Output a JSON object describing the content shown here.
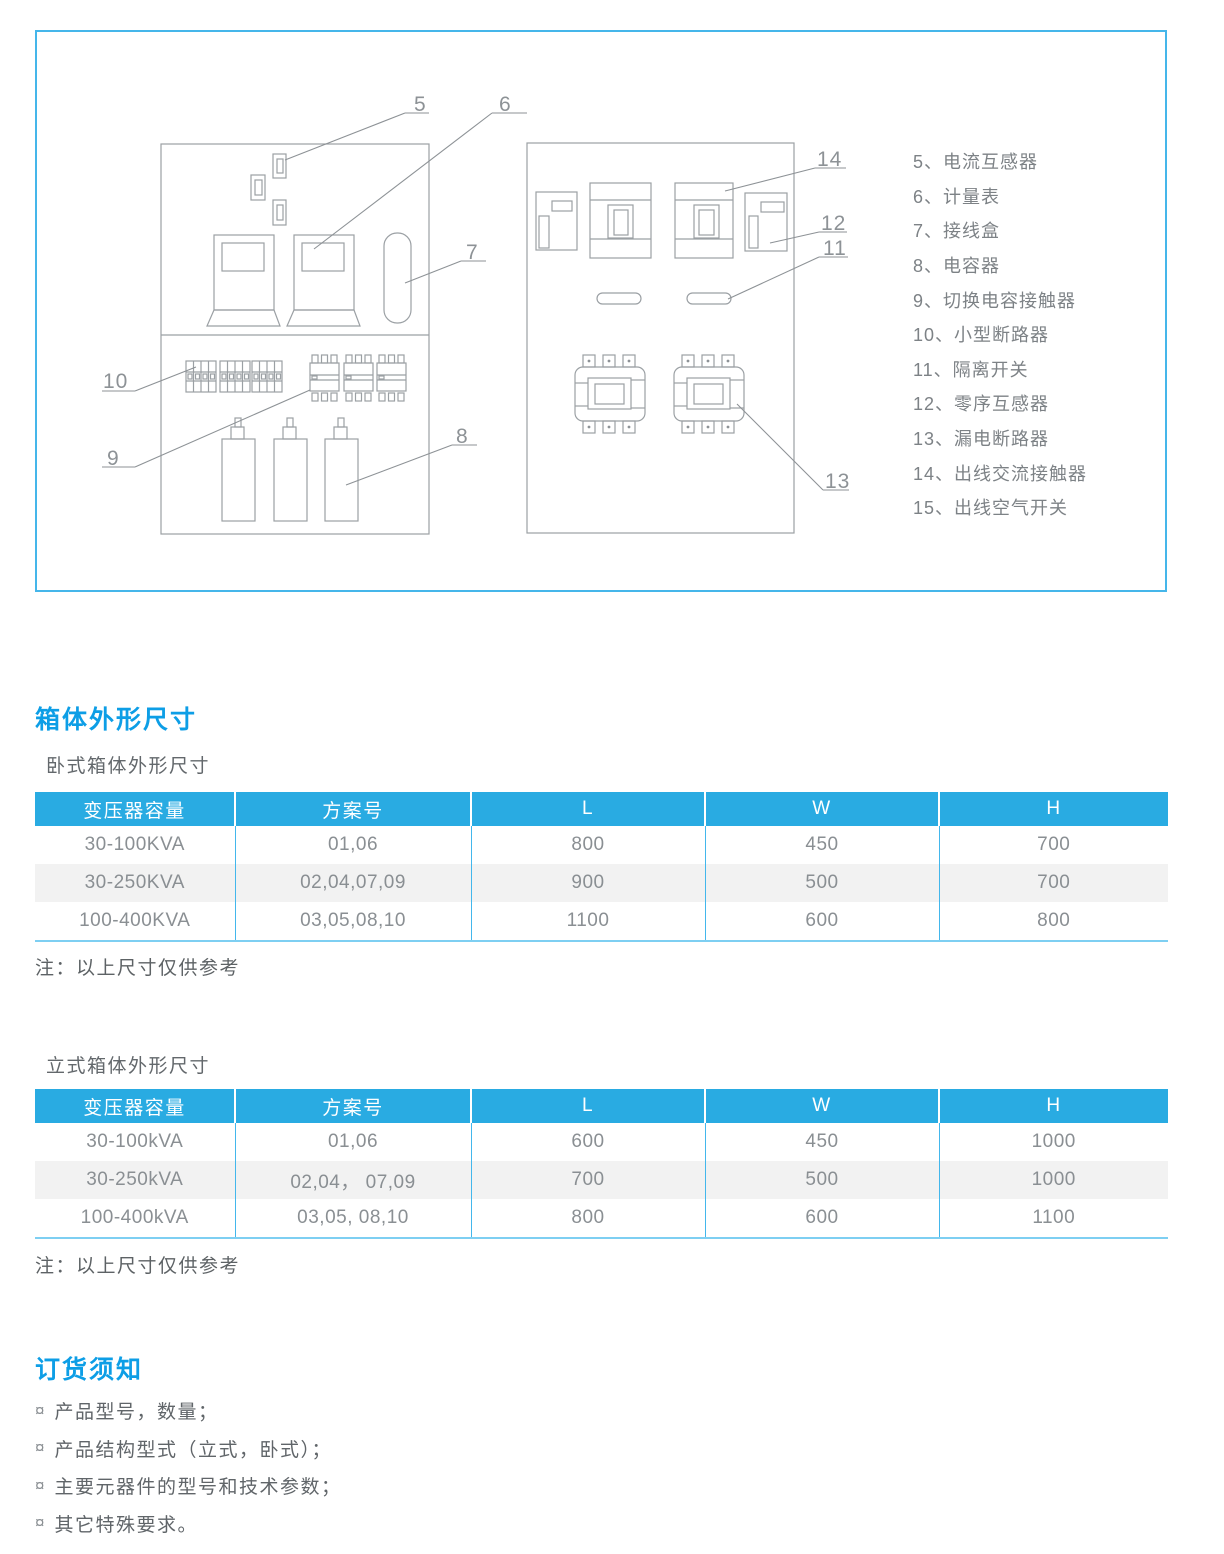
{
  "diagram": {
    "legend": [
      "5、电流互感器",
      "6、计量表",
      "7、接线盒",
      "8、电容器",
      "9、切换电容接触器",
      "10、小型断路器",
      "11、隔离开关",
      "12、零序互感器",
      "13、漏电断路器",
      "14、出线交流接触器",
      "15、出线空气开关"
    ],
    "callouts": {
      "c5": "5",
      "c6": "6",
      "c7": "7",
      "c8": "8",
      "c9": "9",
      "c10": "10",
      "c11": "11",
      "c12": "12",
      "c13": "13",
      "c14": "14"
    }
  },
  "dimensions": {
    "title": "箱体外形尺寸",
    "horizontal": {
      "subtitle": "卧式箱体外形尺寸",
      "columns": [
        "变压器容量",
        "方案号",
        "L",
        "W",
        "H"
      ],
      "rows": [
        [
          "30-100KVA",
          "01,06",
          "800",
          "450",
          "700"
        ],
        [
          "30-250KVA",
          "02,04,07,09",
          "900",
          "500",
          "700"
        ],
        [
          "100-400KVA",
          "03,05,08,10",
          "1100",
          "600",
          "800"
        ]
      ],
      "note": "注：以上尺寸仅供参考"
    },
    "vertical": {
      "subtitle": "立式箱体外形尺寸",
      "columns": [
        "变压器容量",
        "方案号",
        "L",
        "W",
        "H"
      ],
      "rows": [
        [
          "30-100kVA",
          "01,06",
          "600",
          "450",
          "1000"
        ],
        [
          "30-250kVA",
          "02,04， 07,09",
          "700",
          "500",
          "1000"
        ],
        [
          "100-400kVA",
          "03,05, 08,10",
          "800",
          "600",
          "1100"
        ]
      ],
      "note": "注：以上尺寸仅供参考"
    }
  },
  "ordering": {
    "title": "订货须知",
    "bullet": "¤",
    "items": [
      "产品型号，数量；",
      "产品结构型式（立式，卧式）；",
      "主要元器件的型号和技术参数；",
      "其它特殊要求。"
    ]
  },
  "colors": {
    "title_blue": "#0d9ee6",
    "table_header_blue": "#29abe2",
    "row_stripe": "#f2f2f2",
    "panel_border": "#45b6ea"
  }
}
